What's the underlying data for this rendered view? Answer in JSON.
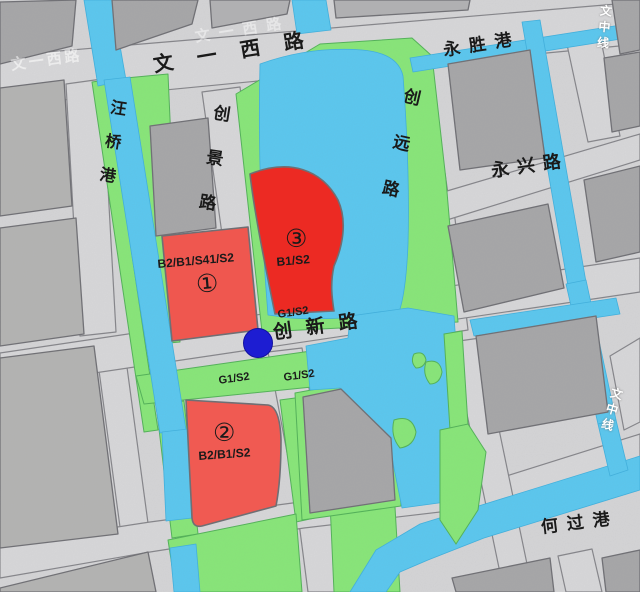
{
  "map": {
    "roads": {
      "wen_yi_xi_lu": "文一西路",
      "chuang_jing_lu": "创景路",
      "chuang_yuan_lu": "创远路",
      "yong_xing_lu": "永兴路",
      "chuang_xin_lu": "创新路"
    },
    "waterways": {
      "wang_qiao_gang": "汪桥港",
      "yong_sheng_gang": "永胜港",
      "he_guo_gang": "何过港",
      "wen_zhong_xian": "文中线"
    },
    "parcels": [
      {
        "number": "①",
        "code": "B2/B1/S41/S2",
        "color": "#ef574f"
      },
      {
        "number": "②",
        "code": "B2/B1/S2",
        "color": "#f05a52"
      },
      {
        "number": "③",
        "code": "B1/S2",
        "color": "#ec2a23"
      }
    ],
    "green_space_label": "G1/S2",
    "legend_colors": {
      "commercial_red": "#ee2c26",
      "green_space": "#87e678",
      "water": "#5ac7ef",
      "road": "#d4d4d6",
      "block": "#a6a6a8",
      "site_marker": "#1d1dd2"
    }
  }
}
